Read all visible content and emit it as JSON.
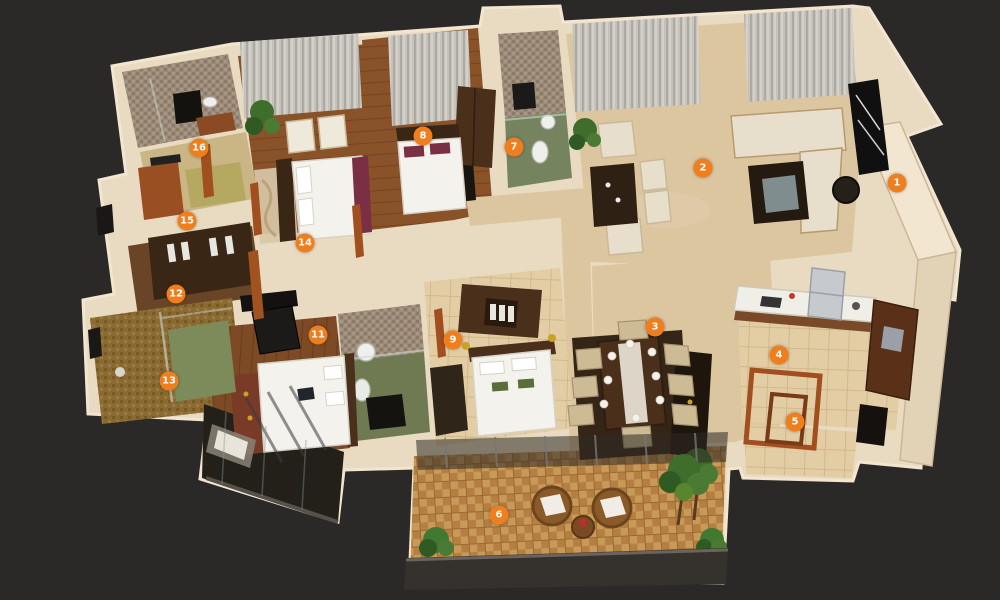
{
  "palette": {
    "background": "#2b2927",
    "wall": "#e9dbc2",
    "wall_light": "#f2e6d0",
    "wall_shadow": "#cdb698",
    "marble_floor": "#dcc69f",
    "wood_floor": "#8a5228",
    "parquet_floor": "#c08a4a",
    "tile_floor": "#e2cda4",
    "mosaic_floor": "#9c8b79",
    "bath_green_floor": "#75845e",
    "gold_mosaic": "#8a6a33",
    "dark_wood": "#4a2f1a",
    "rug_dark": "#352517",
    "cream_fabric": "#e7decb",
    "white_linen": "#f4f2ed",
    "curtain": "#c6c3bc",
    "glass": "#9fb4ba",
    "greenery": "#3f6e2c",
    "balcony_dark": "#232019",
    "railing_dark": "#35312c",
    "accent_door_frame": "#a14f1f",
    "maroon_textile": "#7a2f45",
    "steel": "#c6c9cd",
    "marker": "#ef7e1e",
    "marker_text": "#ffffff"
  },
  "markers": [
    {
      "number": "1",
      "x": 897,
      "y": 183
    },
    {
      "number": "2",
      "x": 703,
      "y": 168
    },
    {
      "number": "3",
      "x": 655,
      "y": 327
    },
    {
      "number": "4",
      "x": 779,
      "y": 355
    },
    {
      "number": "5",
      "x": 795,
      "y": 422
    },
    {
      "number": "6",
      "x": 499,
      "y": 515
    },
    {
      "number": "7",
      "x": 514,
      "y": 147
    },
    {
      "number": "8",
      "x": 423,
      "y": 136
    },
    {
      "number": "9",
      "x": 453,
      "y": 340
    },
    {
      "number": "11",
      "x": 318,
      "y": 335
    },
    {
      "number": "12",
      "x": 176,
      "y": 294
    },
    {
      "number": "13",
      "x": 169,
      "y": 381
    },
    {
      "number": "14",
      "x": 305,
      "y": 243
    },
    {
      "number": "15",
      "x": 187,
      "y": 221
    },
    {
      "number": "16",
      "x": 199,
      "y": 148
    }
  ]
}
